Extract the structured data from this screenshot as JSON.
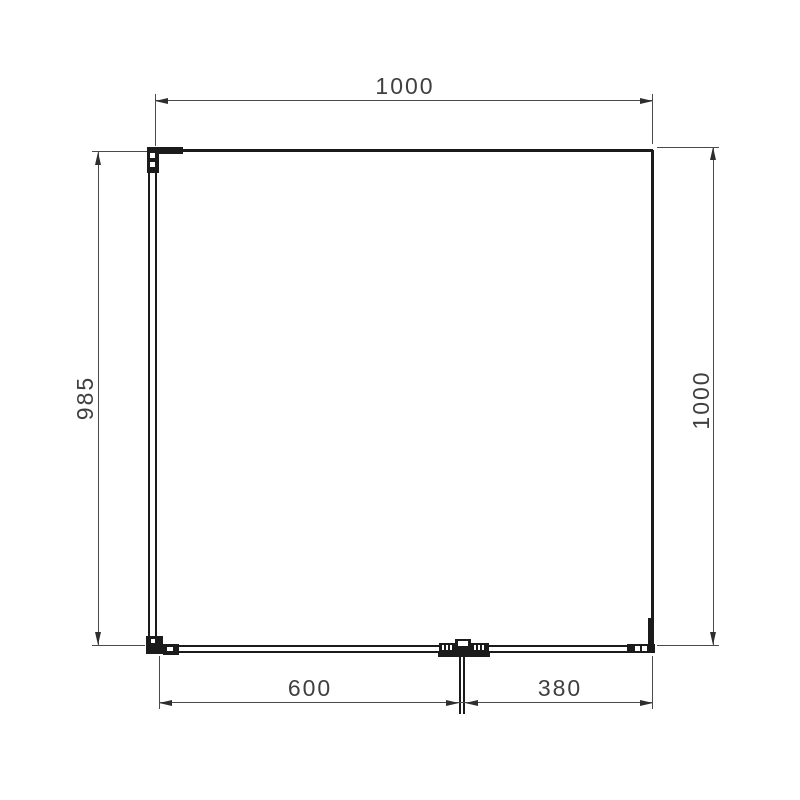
{
  "drawing": {
    "type": "technical-dimension-drawing",
    "dimensions": {
      "top_width": "1000",
      "left_height": "985",
      "right_height": "1000",
      "bottom_left_segment": "600",
      "bottom_right_segment": "380"
    },
    "colors": {
      "background": "#ffffff",
      "object_line": "#1b1b1b",
      "dimension_line": "#4a4a4a",
      "dimension_text": "#3f3f3f"
    }
  }
}
